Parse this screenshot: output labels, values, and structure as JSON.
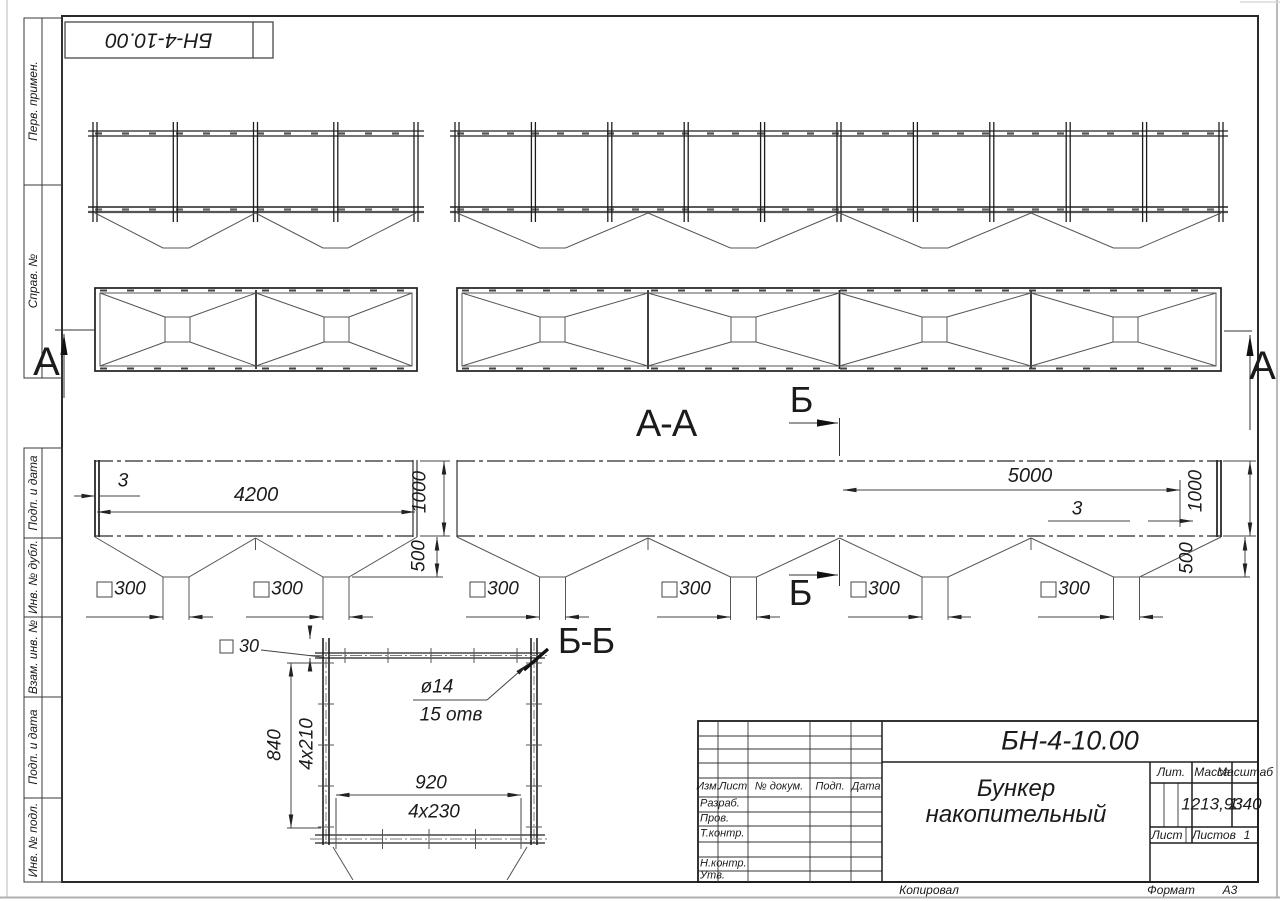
{
  "stamp": {
    "doc_number_rotated": "БН-4-10.00"
  },
  "margin_labels": {
    "perv_primen": "Перв. примен.",
    "sprav_no": "Справ. №",
    "podp_data_1": "Подп. и дата",
    "inv_dubl": "Инв. № дубл.",
    "vzam_inv": "Взам. инв. №",
    "podp_data_2": "Подп. и дата",
    "inv_podl": "Инв. № подл."
  },
  "views": {
    "section_aa_label": "А-А",
    "section_bb_label": "Б-Б",
    "cut_a_left": "А",
    "cut_a_right": "А",
    "cut_b_top": "Б",
    "cut_b_bottom": "Б"
  },
  "dimensions": {
    "aa_left": {
      "wall": "3",
      "length": "4200",
      "height": "1000",
      "hopper": "500",
      "outlet_1": "300",
      "outlet_2": "300"
    },
    "aa_right": {
      "length": "5000",
      "wall": "3",
      "height": "1000",
      "hopper": "500",
      "outlet_1": "300",
      "outlet_2": "300",
      "outlet_3": "300",
      "outlet_4": "300"
    },
    "bb": {
      "angle": "30",
      "total_height": "840",
      "pitch_v": "4x210",
      "hole": "ø14",
      "holes_count": "15 отв",
      "width": "920",
      "pitch_h": "4x230"
    }
  },
  "title_block": {
    "doc_number": "БН-4-10.00",
    "name_line1": "Бункер",
    "name_line2": "накопительный",
    "col_izm": "Изм.",
    "col_list": "Лист",
    "col_doc": "№ докум.",
    "col_podp": "Подп.",
    "col_data": "Дата",
    "row_razrab": "Разраб.",
    "row_prov": "Пров.",
    "row_tkontr": "Т.контр.",
    "row_nkontr": "Н.контр.",
    "row_utv": "Утв.",
    "lit_label": "Лит.",
    "mass_label": "Масса",
    "scale_label": "Масштаб",
    "mass_value": "1213,93",
    "scale_value": "1:40",
    "sheet_label": "Лист",
    "sheets_label": "Листов",
    "sheets_value": "1",
    "kopiroval": "Копировал",
    "format_label": "Формат",
    "format_value": "А3"
  }
}
